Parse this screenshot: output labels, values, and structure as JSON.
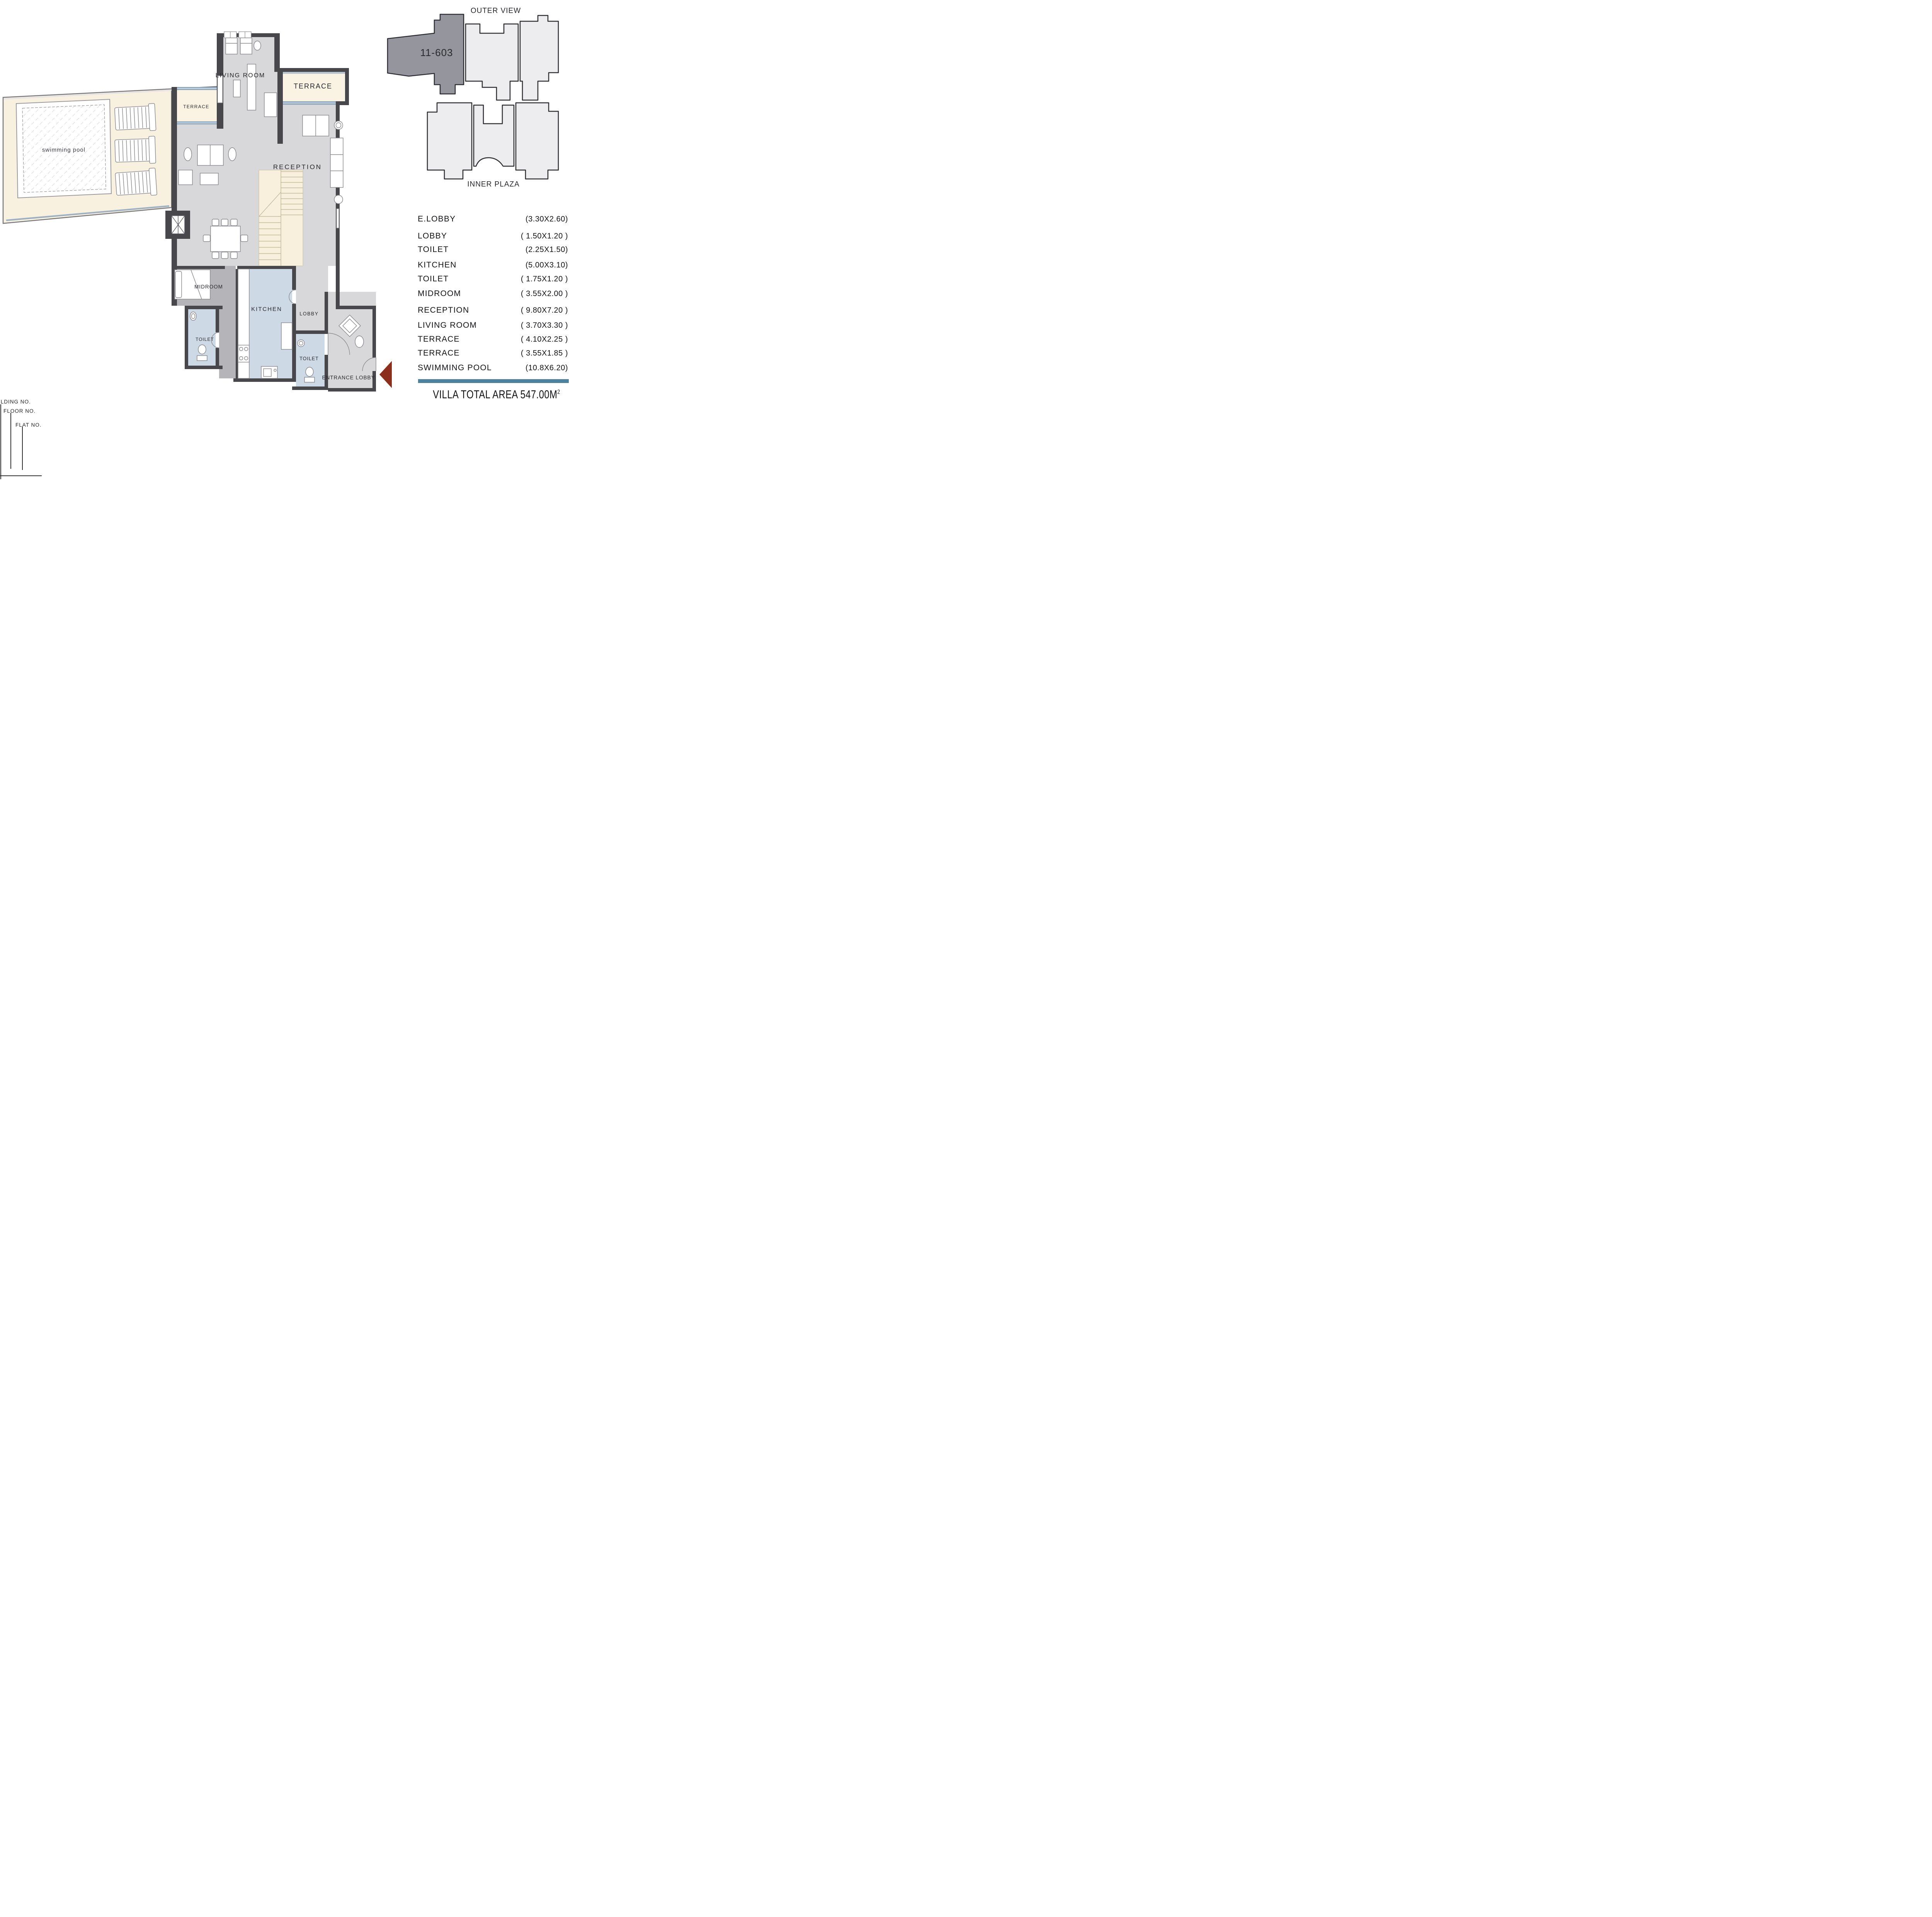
{
  "key_plan": {
    "outer_view_label": "OUTER VIEW",
    "unit_number": "11-603",
    "inner_plaza_label": "INNER PLAZA"
  },
  "plan_labels": {
    "swimming_pool": "swimming pool",
    "terrace_left": "TERRACE",
    "living_room": "LIVING ROOM",
    "terrace_top": "TERRACE",
    "reception": "RECEPTION",
    "midroom": "MIDROOM",
    "toilet_mid": "TOILET",
    "kitchen": "KITCHEN",
    "lobby": "LOBBY",
    "toilet_entry": "TOILET",
    "entrance_lobby": "ENTRANCE LOBBY"
  },
  "room_schedule": {
    "rows": [
      {
        "name": "E.LOBBY",
        "dims": "(3.30X2.60)"
      },
      {
        "name": "LOBBY",
        "dims": "( 1.50X1.20 )"
      },
      {
        "name": "TOILET",
        "dims": "(2.25X1.50)"
      },
      {
        "name": "KITCHEN",
        "dims": "(5.00X3.10)"
      },
      {
        "name": "TOILET",
        "dims": "( 1.75X1.20 )"
      },
      {
        "name": "MIDROOM",
        "dims": "( 3.55X2.00 )"
      },
      {
        "name": "RECEPTION",
        "dims": "( 9.80X7.20 )"
      },
      {
        "name": "LIVING ROOM",
        "dims": "( 3.70X3.30 )"
      },
      {
        "name": "TERRACE",
        "dims": "( 4.10X2.25 )"
      },
      {
        "name": "TERRACE",
        "dims": "( 3.55X1.85 )"
      },
      {
        "name": "SWIMMING POOL",
        "dims": "(10.8X6.20)"
      }
    ]
  },
  "total_area": {
    "text": "VILLA TOTAL AREA 547.00M",
    "superscript": "2"
  },
  "legend": {
    "building_no": "ILDING NO.",
    "floor_no": "FLOOR NO.",
    "flat_no": "FLAT NO."
  },
  "colors": {
    "wall": "#47474c",
    "floor": "#d8d8da",
    "floor_dark": "#b5b5b9",
    "terrace_cream": "#faf3e4",
    "pool_deck": "#f8f1df",
    "wet_floor": "#cdd9e5",
    "glazing": "#8fa9be",
    "key_unit_fill": "#95959d",
    "key_mass_fill": "#ededef",
    "divider_bar": "#4f81a1",
    "entry_arrow": "#8c2e1c"
  }
}
